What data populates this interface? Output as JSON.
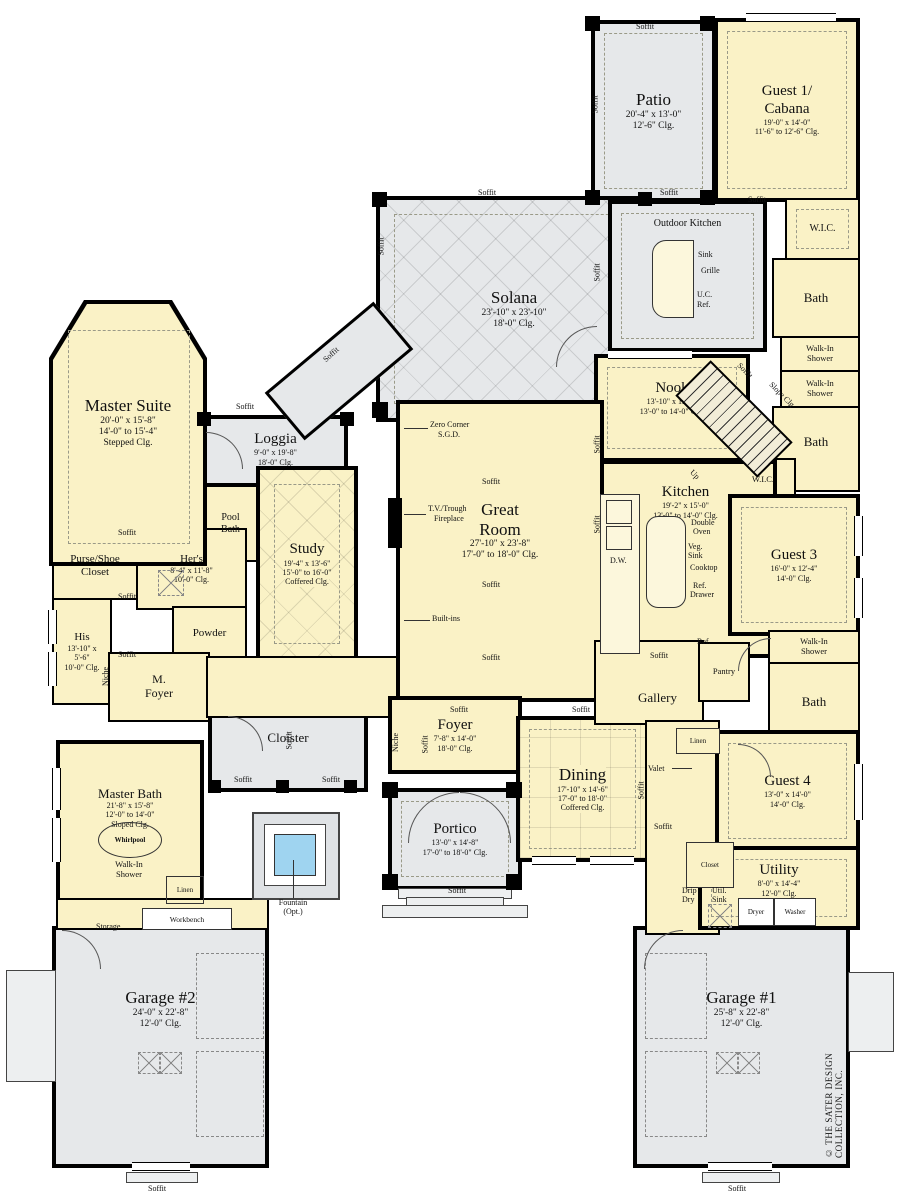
{
  "copyright": "© THE SATER DESIGN COLLECTION, INC.",
  "labels": {
    "soffit": "Soffit",
    "niche": "Niche",
    "up": "Up",
    "slope": "Slope Clg"
  },
  "rooms": {
    "patio": {
      "name": "Patio",
      "d1": "20'-4\" x 13'-0\"",
      "d2": "12'-6\" Clg."
    },
    "guest1": {
      "n1": "Guest 1/",
      "n2": "Cabana",
      "d1": "19'-0\" x 14'-0\"",
      "d2": "11'-6\" to 12'-6\" Clg."
    },
    "outdoor_kitchen": {
      "name": "Outdoor Kitchen"
    },
    "solana": {
      "name": "Solana",
      "d1": "23'-10\" x 23'-10\"",
      "d2": "18'-0\" Clg."
    },
    "nook": {
      "name": "Nook",
      "d1": "13'-10\" x 15'-0\"",
      "d2": "13'-0\" to 14'-0\" Clg."
    },
    "kitchen": {
      "name": "Kitchen",
      "d1": "19'-2\" x 15'-0\"",
      "d2": "13'-0\" to 14'-0\" Clg."
    },
    "great_room": {
      "n1": "Great",
      "n2": "Room",
      "d1": "27'-10\" x 23'-8\"",
      "d2": "17'-0\" to 18'-0\" Clg."
    },
    "master_suite": {
      "name": "Master Suite",
      "d1": "20'-0\" x 15'-8\"",
      "d2": "14'-0\" to 15'-4\"",
      "d3": "Stepped Clg."
    },
    "loggia": {
      "name": "Loggia",
      "d1": "9'-0\" x 19'-8\"",
      "d2": "18'-0\" Clg."
    },
    "pool_bath": {
      "n1": "Pool",
      "n2": "Bath"
    },
    "study": {
      "name": "Study",
      "d1": "19'-4\" x 13'-6\"",
      "d2": "15'-0\" to 16'-0\"",
      "d3": "Coffered Clg."
    },
    "purse": {
      "n1": "Purse/Shoe",
      "n2": "Closet"
    },
    "hers": {
      "name": "Her's",
      "d1": "8'-4\" x 11'-8\"",
      "d2": "10'-0\" Clg."
    },
    "his": {
      "name": "His",
      "d1": "13'-10\" x",
      "d2": "5'-6\"",
      "d3": "10'-0\" Clg."
    },
    "powder": {
      "name": "Powder"
    },
    "mfoyer": {
      "n1": "M.",
      "n2": "Foyer"
    },
    "gallery": {
      "name": "Gallery"
    },
    "pantry": {
      "name": "Pantry"
    },
    "guest3": {
      "name": "Guest 3",
      "d1": "16'-0\" x 12'-4\"",
      "d2": "14'-0\" Clg."
    },
    "guest4": {
      "name": "Guest 4",
      "d1": "13'-0\" x 14'-0\"",
      "d2": "14'-0\" Clg."
    },
    "foyer": {
      "name": "Foyer",
      "d1": "7'-8\" x 14'-0\"",
      "d2": "18'-0\" Clg."
    },
    "dining": {
      "name": "Dining",
      "d1": "17'-10\" x 14'-6\"",
      "d2": "17'-0\" to 18'-0\"",
      "d3": "Coffered Clg."
    },
    "cloister": {
      "name": "Cloister"
    },
    "portico": {
      "name": "Portico",
      "d1": "13'-0\" x 14'-8\"",
      "d2": "17'-0\" to 18'-0\" Clg."
    },
    "master_bath": {
      "name": "Master Bath",
      "d1": "21'-8\" x 15'-8\"",
      "d2": "12'-0\" to 14'-0\"",
      "d3": "Sloped Clg."
    },
    "utility": {
      "name": "Utility",
      "d1": "8'-0\" x 14'-4\"",
      "d2": "12'-0\" Clg."
    },
    "garage1": {
      "name": "Garage #1",
      "d1": "25'-8\" x 22'-8\"",
      "d2": "12'-0\" Clg."
    },
    "garage2": {
      "name": "Garage #2",
      "d1": "24'-0\" x 22'-8\"",
      "d2": "12'-0\" Clg."
    },
    "wic": {
      "name": "W.I.C."
    },
    "bath": {
      "name": "Bath"
    },
    "walkin": {
      "n1": "Walk-In",
      "n2": "Shower"
    }
  },
  "fixtures": {
    "sink": "Sink",
    "grille": "Grille",
    "uc1": "U.C.",
    "uc2": "Ref.",
    "dw": "D.W.",
    "double1": "Double",
    "double2": "Oven",
    "veg1": "Veg.",
    "veg2": "Sink",
    "cooktop": "Cooktop",
    "refd1": "Ref.",
    "refd2": "Drawer",
    "ref": "Ref.",
    "linen": "Linen",
    "valet": "Valet",
    "closet": "Closet",
    "drip1": "Drip",
    "drip2": "Dry",
    "usink1": "Util.",
    "usink2": "Sink",
    "dryer": "Dryer",
    "washer": "Washer",
    "whirlpool": "Whirlpool",
    "storage": "Storage",
    "workbench": "Workbench",
    "fountain1": "Fountain",
    "fountain2": "(Opt.)",
    "zero1": "Zero Corner",
    "zero2": "S.G.D.",
    "tv1": "T.V./Trough",
    "tv2": "Fireplace",
    "builtins": "Built-ins"
  }
}
